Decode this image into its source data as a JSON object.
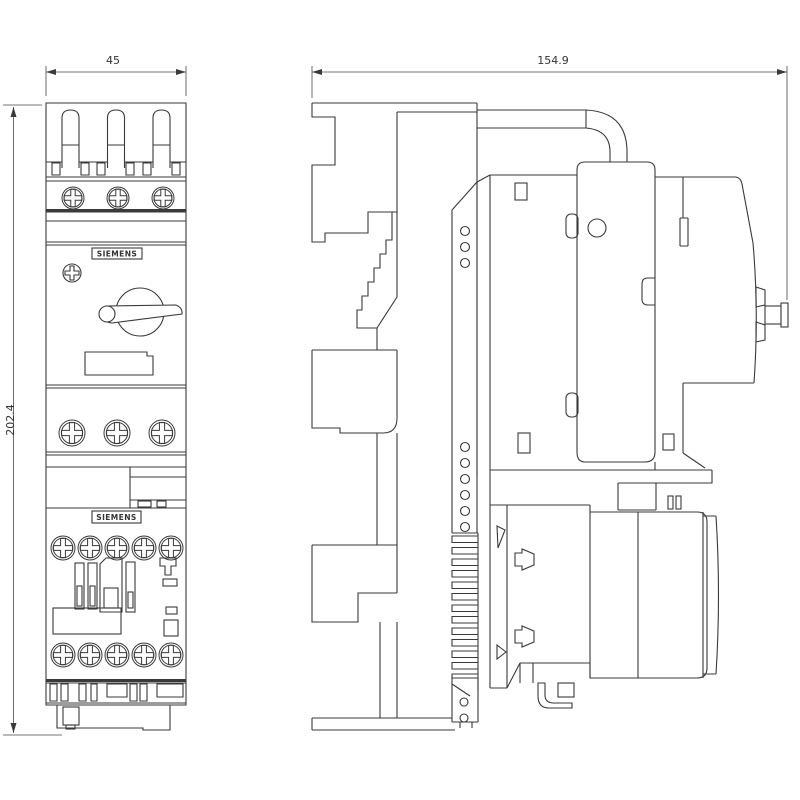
{
  "page": {
    "background": "#ffffff",
    "line_color": "#3a3a3a",
    "type": "technical-dimension-drawing"
  },
  "drawing": {
    "brand": "SIEMENS",
    "front_view": {
      "label_top": "SIEMENS",
      "label_bottom": "SIEMENS",
      "width_dim": "45",
      "height_dim": "202.4"
    },
    "side_view": {
      "depth_dim": "154.9"
    }
  }
}
